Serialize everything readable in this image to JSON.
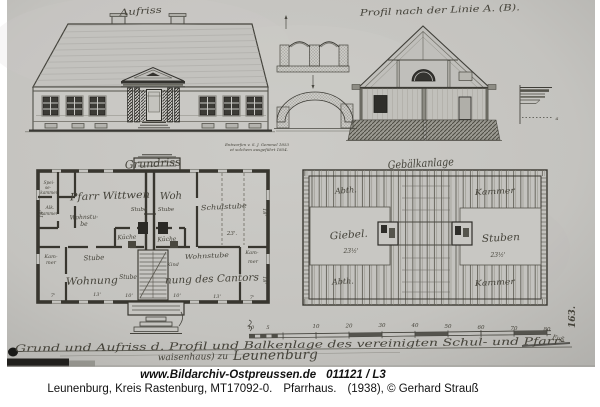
{
  "footer": {
    "line1_site": "www.Bildarchiv-Ostpreussen.de",
    "line1_id": "011121 / L3",
    "line2_location": "Leunenburg, Kreis Rastenburg, MT17092-0.",
    "line2_subject": "Pfarrhaus.",
    "line2_credit": "(1938), © Gerhard Strauß"
  },
  "colors": {
    "paper": "#c6c5c1",
    "ink": "#3d3c35",
    "ink_dark": "#23221f",
    "footer_text": "#121212",
    "background": "#ffffff"
  },
  "labels": {
    "elevation": [
      {
        "t": "Aufriss",
        "x": 141,
        "y": 14,
        "s": 9,
        "r": -4,
        "len": 42
      },
      {
        "t": "Entworfen v. S. J. Gemmel 1853",
        "x": 257,
        "y": 146,
        "s": 4
      },
      {
        "t": "et solchem ausgeführt 1854.",
        "x": 259,
        "y": 151,
        "s": 4
      }
    ],
    "section": [
      {
        "t": "Profil nach der Linie A. (B).",
        "x": 440,
        "y": 13,
        "s": 9,
        "r": -2,
        "len": 160
      }
    ],
    "plan": [
      {
        "t": "Grundriss",
        "x": 153,
        "y": 167,
        "s": 11,
        "r": -3,
        "len": 56
      },
      {
        "t": "Pfarr Wittwen",
        "x": 110,
        "y": 199,
        "s": 10,
        "r": -2,
        "len": 80
      },
      {
        "t": "Woh",
        "x": 171,
        "y": 199,
        "s": 10,
        "r": -2
      },
      {
        "t": "Stube",
        "x": 139,
        "y": 211,
        "s": 5.5
      },
      {
        "t": "Stube",
        "x": 166,
        "y": 211,
        "s": 5.5
      },
      {
        "t": "Schulstube",
        "x": 224,
        "y": 209,
        "s": 7,
        "r": -3,
        "len": 46
      },
      {
        "t": "23'.",
        "x": 232,
        "y": 235,
        "s": 5.5
      },
      {
        "t": "Spei-",
        "x": 49,
        "y": 184,
        "s": 4.2
      },
      {
        "t": "se-",
        "x": 48,
        "y": 189,
        "s": 4.2
      },
      {
        "t": "kammer",
        "x": 49,
        "y": 194,
        "s": 4.2
      },
      {
        "t": "Alk.",
        "x": 50,
        "y": 209,
        "s": 4.5
      },
      {
        "t": "kammer",
        "x": 49,
        "y": 215,
        "s": 4.2
      },
      {
        "t": "Wohnstu-",
        "x": 84,
        "y": 219,
        "s": 6,
        "r": -2
      },
      {
        "t": "be",
        "x": 84,
        "y": 226,
        "s": 6
      },
      {
        "t": "Küche",
        "x": 127,
        "y": 239,
        "s": 6,
        "r": -2
      },
      {
        "t": "Küche",
        "x": 167,
        "y": 241,
        "s": 6,
        "r": -2
      },
      {
        "t": "Kam-",
        "x": 51,
        "y": 258,
        "s": 5
      },
      {
        "t": "mer",
        "x": 51,
        "y": 264,
        "s": 5
      },
      {
        "t": "Stube",
        "x": 94,
        "y": 260,
        "s": 7,
        "r": -2
      },
      {
        "t": "Wohnung",
        "x": 92,
        "y": 284,
        "s": 10,
        "r": -2,
        "len": 52
      },
      {
        "t": "Stube",
        "x": 128,
        "y": 279,
        "s": 6
      },
      {
        "t": "Kind",
        "x": 173,
        "y": 266,
        "s": 5
      },
      {
        "t": "Wohnstube",
        "x": 207,
        "y": 258,
        "s": 6.5,
        "r": -3,
        "len": 44
      },
      {
        "t": "nung des Cantors",
        "x": 212,
        "y": 282,
        "s": 10,
        "r": -2,
        "len": 94
      },
      {
        "t": "Kam-",
        "x": 252,
        "y": 254,
        "s": 5
      },
      {
        "t": "mer",
        "x": 253,
        "y": 263,
        "s": 5
      },
      {
        "t": "7'",
        "x": 53,
        "y": 297,
        "s": 5
      },
      {
        "t": "13'",
        "x": 97,
        "y": 296,
        "s": 5
      },
      {
        "t": "10'",
        "x": 129,
        "y": 297,
        "s": 5
      },
      {
        "t": "10'",
        "x": 177,
        "y": 297,
        "s": 5
      },
      {
        "t": "13'",
        "x": 217,
        "y": 298,
        "s": 5
      },
      {
        "t": "7'",
        "x": 252,
        "y": 299,
        "s": 5
      },
      {
        "t": "18'",
        "x": 263,
        "y": 212,
        "s": 5,
        "r": 90
      },
      {
        "t": "18'",
        "x": 263,
        "y": 280,
        "s": 5,
        "r": 90
      },
      {
        "t": "18'",
        "x": 43,
        "y": 214,
        "s": 5,
        "r": -90
      }
    ],
    "beam": [
      {
        "t": "Gebälkanlage",
        "x": 421,
        "y": 167,
        "s": 11,
        "r": -3,
        "len": 66
      },
      {
        "t": "Abth.",
        "x": 346,
        "y": 193,
        "s": 8,
        "r": -4
      },
      {
        "t": "Kammer",
        "x": 495,
        "y": 194,
        "s": 8,
        "r": -3,
        "len": 40
      },
      {
        "t": "Giebel.",
        "x": 349,
        "y": 238,
        "s": 10,
        "r": -4,
        "len": 38
      },
      {
        "t": "23½'",
        "x": 351,
        "y": 253,
        "s": 6
      },
      {
        "t": "Stuben",
        "x": 501,
        "y": 241,
        "s": 10,
        "r": -3,
        "len": 38
      },
      {
        "t": "23½'",
        "x": 498,
        "y": 257,
        "s": 6
      },
      {
        "t": "Abth.",
        "x": 343,
        "y": 284,
        "s": 8,
        "r": -3
      },
      {
        "t": "Kammer",
        "x": 495,
        "y": 285,
        "s": 8,
        "r": -3,
        "len": 40
      },
      {
        "t": "163.",
        "x": 575,
        "y": 317,
        "s": 9,
        "r": -90,
        "w": "bold",
        "c": "#2e2d28"
      }
    ],
    "scale": [
      {
        "t": "10",
        "x": 251,
        "y": 329,
        "s": 5
      },
      {
        "t": "5",
        "x": 268,
        "y": 329,
        "s": 5
      },
      {
        "t": "10",
        "x": 316,
        "y": 328,
        "s": 5.5
      },
      {
        "t": "20",
        "x": 349,
        "y": 327.5,
        "s": 5.5
      },
      {
        "t": "30",
        "x": 382,
        "y": 327,
        "s": 5.5
      },
      {
        "t": "40",
        "x": 415,
        "y": 327,
        "s": 5.5
      },
      {
        "t": "50",
        "x": 448,
        "y": 328,
        "s": 5.5
      },
      {
        "t": "60",
        "x": 481,
        "y": 329,
        "s": 5.5
      },
      {
        "t": "70",
        "x": 514,
        "y": 330,
        "s": 5.5
      },
      {
        "t": "80",
        "x": 547,
        "y": 331,
        "s": 5.5
      },
      {
        "t": "Fuß",
        "x": 558,
        "y": 340,
        "s": 6,
        "r": 15
      }
    ],
    "caption": [
      {
        "t": "Grund und Aufriss d. Profil und Balkenlage des vereinigten Schul- und Pfarr-",
        "x": 290,
        "y": 348,
        "s": 10,
        "r": -0.8,
        "len": 550,
        "c": "#3c3a33"
      },
      {
        "t": "waisenhaus) zu",
        "x": 228,
        "y": 359,
        "s": 9,
        "r": -1,
        "a": "end",
        "c": "#3c3a33"
      },
      {
        "t": "Leunenburg",
        "x": 233,
        "y": 360,
        "s": 13,
        "r": -1,
        "a": "start",
        "len": 85,
        "c": "#3c3a33"
      },
      {
        "t": "a",
        "x": 557,
        "y": 120,
        "s": 5
      }
    ]
  }
}
